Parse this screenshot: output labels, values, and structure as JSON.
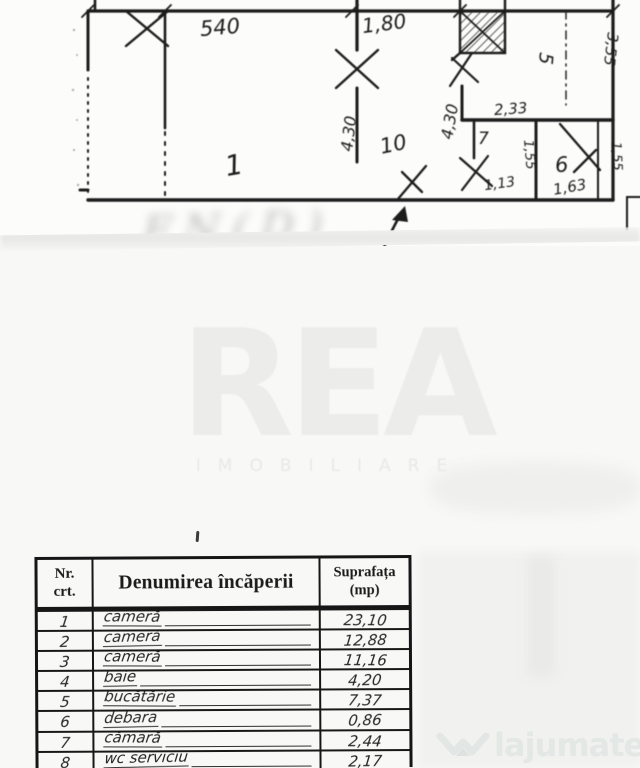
{
  "floor_plan": {
    "dims": {
      "d540": "540",
      "d180": "1,80",
      "d430a": "4,30",
      "d430b": "4,30",
      "d233": "2,33",
      "d355": "3,55",
      "d155a": "1,55",
      "d113": "1,13",
      "d163": "1,63",
      "d155b": "1,55"
    },
    "rooms": {
      "r1": "1",
      "r10": "10",
      "r5": "5",
      "r6": "6",
      "r7": "7"
    },
    "stamp": "FN(D)"
  },
  "watermark": {
    "brand": "REA",
    "subtitle": "IMOBILIARE"
  },
  "table": {
    "header": {
      "col1_line1": "Nr.",
      "col1_line2": "crt.",
      "col2": "Denumirea încăperii",
      "col3_line1": "Suprafața",
      "col3_line2": "(mp)"
    },
    "rows": [
      {
        "nr": "1",
        "name": "cameră",
        "area": "23,10"
      },
      {
        "nr": "2",
        "name": "cameră",
        "area": "12,88"
      },
      {
        "nr": "3",
        "name": "cameră",
        "area": "11,16"
      },
      {
        "nr": "4",
        "name": "baie",
        "area": "4,20"
      },
      {
        "nr": "5",
        "name": "bucătărie",
        "area": "7,37"
      },
      {
        "nr": "6",
        "name": "debara",
        "area": "0,86"
      },
      {
        "nr": "7",
        "name": "cămară",
        "area": "2,44"
      },
      {
        "nr": "8",
        "name": "wc serviciu",
        "area": "2,17"
      }
    ]
  },
  "logo": {
    "brand": "lajumate",
    "tld": ".ro"
  }
}
